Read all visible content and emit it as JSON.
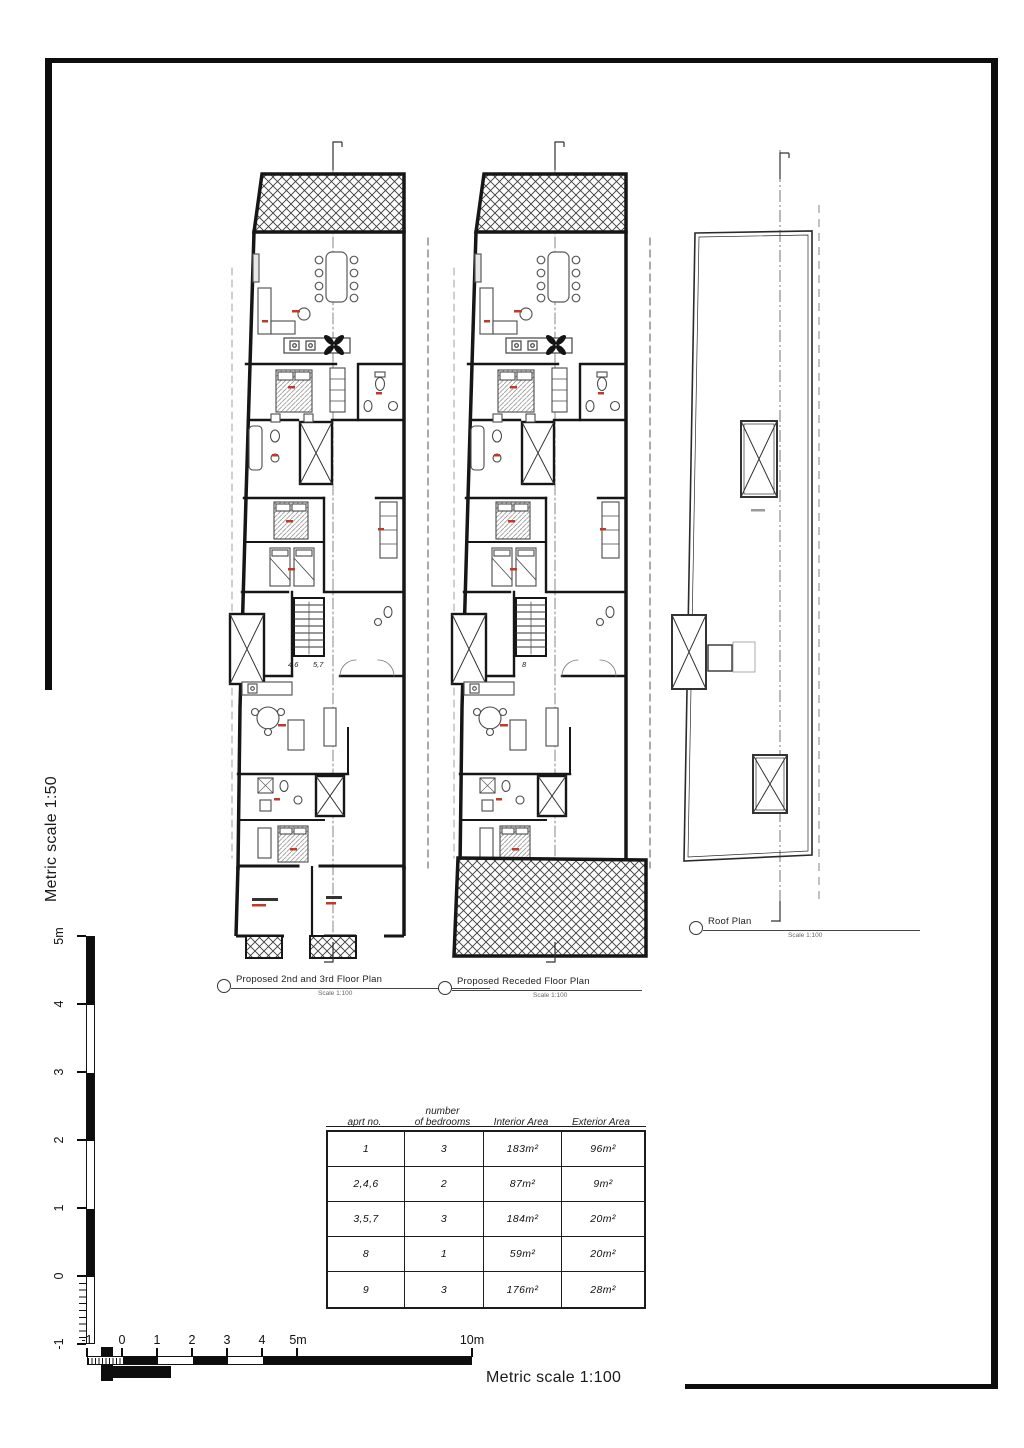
{
  "sheet": {
    "vertical_scale_label": "Metric scale 1:50",
    "horizontal_scale_label": "Metric scale 1:100"
  },
  "vscale": {
    "ticks": [
      "5m",
      "4",
      "3",
      "2",
      "1",
      "0",
      "-1"
    ]
  },
  "hscale": {
    "ticks": [
      "-1",
      "0",
      "1",
      "2",
      "3",
      "4",
      "5m",
      "10m"
    ]
  },
  "plans": {
    "left": {
      "label": "Proposed 2nd and 3rd Floor Plan",
      "scale_note": "Scale 1:100",
      "door_label_a": "4,6",
      "door_label_b": "5,7"
    },
    "middle": {
      "label": "Proposed Receded Floor Plan",
      "scale_note": "Scale 1:100",
      "door_label": "8"
    },
    "roof": {
      "label": "Roof Plan",
      "scale_note": "Scale 1:100"
    }
  },
  "table": {
    "headers": {
      "c1": "aprt  no.",
      "c2": "number\nof bedrooms",
      "c3": "Interior Area",
      "c4": "Exterior Area"
    },
    "rows": [
      {
        "aprt": "1",
        "bedrooms": "3",
        "interior": "183m²",
        "exterior": "96m²"
      },
      {
        "aprt": "2,4,6",
        "bedrooms": "2",
        "interior": "87m²",
        "exterior": "9m²"
      },
      {
        "aprt": "3,5,7",
        "bedrooms": "3",
        "interior": "184m²",
        "exterior": "20m²"
      },
      {
        "aprt": "8",
        "bedrooms": "1",
        "interior": "59m²",
        "exterior": "20m²"
      },
      {
        "aprt": "9",
        "bedrooms": "3",
        "interior": "176m²",
        "exterior": "28m²"
      }
    ]
  },
  "colors": {
    "wall": "#161616",
    "red_label": "#c0392b",
    "frame": "#0d0d0d"
  }
}
